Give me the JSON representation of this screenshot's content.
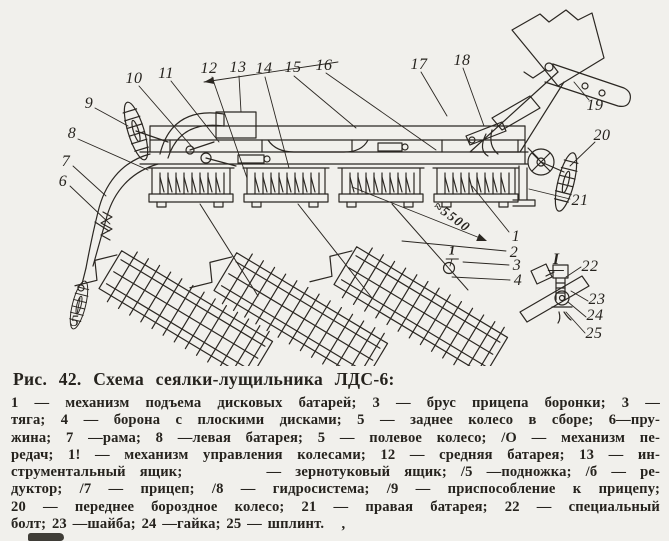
{
  "page": {
    "paper_color": "#f1f0ec",
    "ink_color": "#26231e"
  },
  "caption": {
    "title": "Рис. 42. Схема сеялки-лущильника ЛДС-6:",
    "lines": [
      "1 — механизм подъема дисковых батарей; 3 — брус прицепа боронки; 3 —",
      "тяга; 4 — борона с плоскими дисками; 5 — заднее колесо в сборе; 6—пру-",
      "жина; 7 —рама; 8 —левая батарея; 5 — полевое колесо; /О — механизм пе-",
      "редач; 1! — механизм управления колесами; 12 — средняя батарея; 13 — ин-",
      "струментальный ящик;      — зернотуковый ящик; /5 —подножка; /б — ре-",
      "дуктор; /7 — прицеп; /8 — гидросистема; /9 — приспособление к прицепу;",
      "20 — переднее бороздное колесо; 21 — правая батарея; 22 — специальный",
      "болт; 23 —шайба; 24 —гайка; 25 — шплинт.   ,"
    ]
  },
  "diagram": {
    "dimension_label": "≈5500",
    "detail_view_label": "I",
    "detail_location_marker": "1",
    "callouts": [
      {
        "n": "9",
        "x": 89,
        "y": 104
      },
      {
        "n": "10",
        "x": 134,
        "y": 79
      },
      {
        "n": "11",
        "x": 166,
        "y": 74
      },
      {
        "n": "12",
        "x": 209,
        "y": 69
      },
      {
        "n": "13",
        "x": 238,
        "y": 68
      },
      {
        "n": "14",
        "x": 264,
        "y": 69
      },
      {
        "n": "15",
        "x": 293,
        "y": 68
      },
      {
        "n": "16",
        "x": 324,
        "y": 66
      },
      {
        "n": "17",
        "x": 419,
        "y": 65
      },
      {
        "n": "18",
        "x": 462,
        "y": 61
      },
      {
        "n": "19",
        "x": 595,
        "y": 106
      },
      {
        "n": "20",
        "x": 602,
        "y": 136
      },
      {
        "n": "21",
        "x": 580,
        "y": 201
      },
      {
        "n": "8",
        "x": 72,
        "y": 134
      },
      {
        "n": "7",
        "x": 66,
        "y": 162
      },
      {
        "n": "6",
        "x": 63,
        "y": 182
      },
      {
        "n": "5",
        "x": 75,
        "y": 322
      },
      {
        "n": "1",
        "x": 516,
        "y": 237
      },
      {
        "n": "2",
        "x": 514,
        "y": 253
      },
      {
        "n": "3",
        "x": 517,
        "y": 266
      },
      {
        "n": "4",
        "x": 518,
        "y": 281
      },
      {
        "n": "22",
        "x": 590,
        "y": 267
      },
      {
        "n": "23",
        "x": 597,
        "y": 300
      },
      {
        "n": "24",
        "x": 595,
        "y": 316
      },
      {
        "n": "25",
        "x": 594,
        "y": 334
      }
    ]
  }
}
